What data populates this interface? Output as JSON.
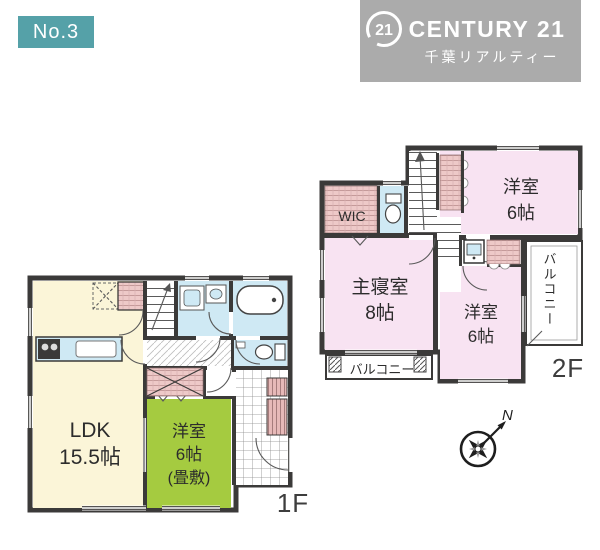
{
  "header": {
    "listing_no": "No.3",
    "brand": {
      "circle_label": "21",
      "name": "CENTURY 21",
      "office": "千葉リアルティー"
    }
  },
  "floor_1f": {
    "label": "1F",
    "ldk_name": "LDK",
    "ldk_size": "15.5帖",
    "tatami_name": "洋室",
    "tatami_size": "6帖",
    "tatami_note": "(畳敷)"
  },
  "floor_2f": {
    "label": "2F",
    "bedroom_ne_name": "洋室",
    "bedroom_ne_size": "6帖",
    "master_name": "主寝室",
    "master_size": "8帖",
    "bedroom_se_name": "洋室",
    "bedroom_se_size": "6帖",
    "wic": "WIC",
    "balcony_south": "バルコニー",
    "balcony_east": "バルコニー"
  },
  "compass": {
    "north": "N"
  },
  "colors": {
    "badge_teal": "#55a1a8",
    "logo_gray": "#ababab",
    "wall_dark": "#3b3a39",
    "room_pink": "#f8e3f2",
    "closet_pink": "#eec9c8",
    "ldk_cream": "#fbf5d8",
    "tatami_green": "#a5cb40",
    "water_blue": "#cfe9f4"
  }
}
